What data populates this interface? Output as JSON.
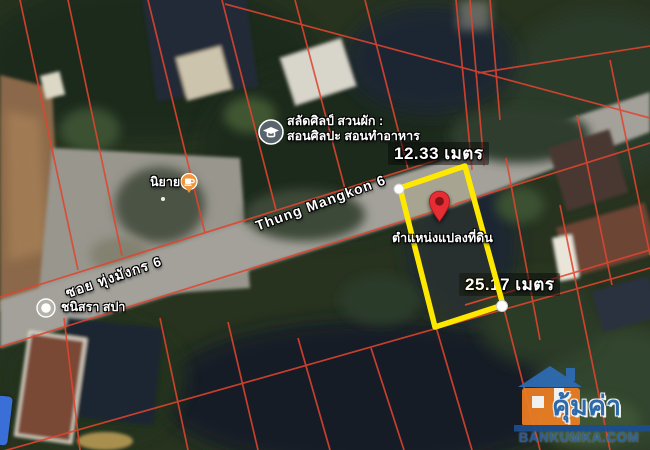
{
  "map": {
    "street_labels": {
      "main_road": "Thung Mangkon 6",
      "soi_road": "ซอย ทุ่งมังกร 6"
    },
    "parcel": {
      "top_measurement": "12.33 เมตร",
      "side_measurement": "25.17 เมตร",
      "caption": "ตำแหน่งแปลงที่ดิน",
      "outline_color": "#ffe800",
      "pin_color": "#e52d33"
    },
    "pois": {
      "education": {
        "name_line1": "สลัดศิลป์ สวนผัก :",
        "name_line2": "สอนศิลปะ สอนทำอาหาร",
        "icon": "graduation-cap-icon",
        "icon_color": "#59646c"
      },
      "cafe": {
        "name": "นิยาย",
        "icon": "cafe-cup-icon",
        "icon_color": "#f0963c"
      },
      "spa": {
        "name": "ชนิสรา สปา",
        "icon": "generic-poi-icon",
        "icon_color": "#b5b3ab"
      }
    },
    "cadastral_line_color": "#e0452f"
  },
  "watermark": {
    "brand_thai": "คุ้มค่า",
    "brand_site": "BANKUMKA.COM",
    "house_color": "#ed7d23",
    "roof_color": "#2e6cb5"
  }
}
